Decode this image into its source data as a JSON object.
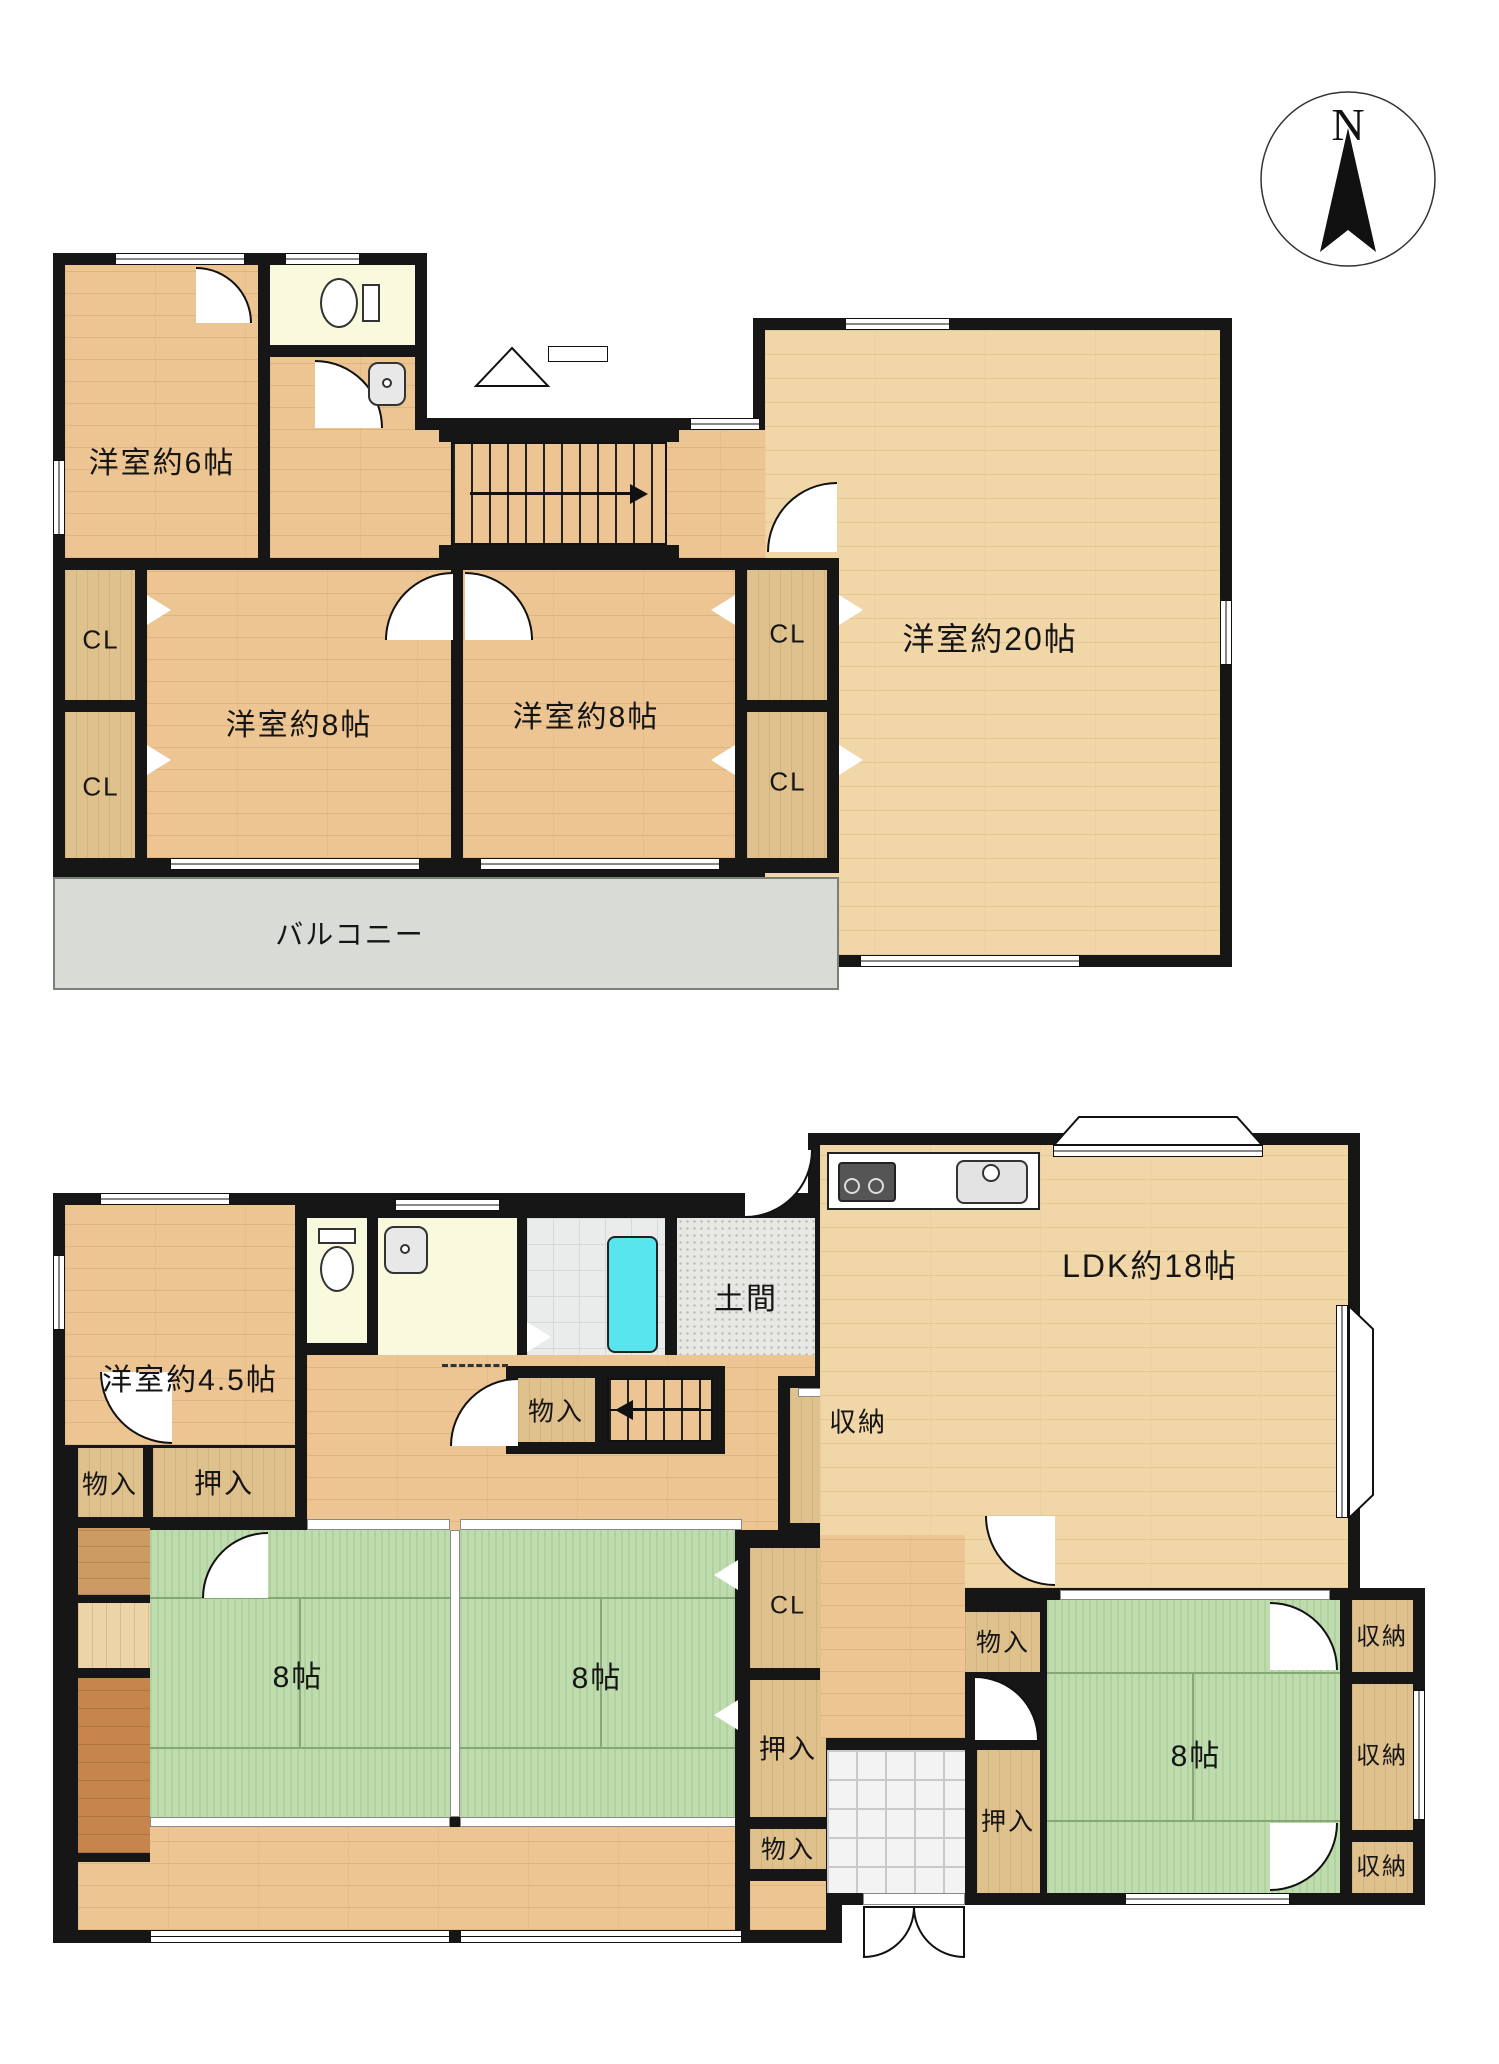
{
  "compass": {
    "label": "N"
  },
  "floor2": {
    "room_6": "洋室約6帖",
    "room_8_left": "洋室約8帖",
    "room_8_right": "洋室約8帖",
    "room_20": "洋室約20帖",
    "balcony": "バルコニー",
    "cl_left_top": "CL",
    "cl_left_bottom": "CL",
    "cl_right_top": "CL",
    "cl_right_bottom": "CL"
  },
  "floor1": {
    "room_45": "洋室約4.5帖",
    "ldk": "LDK約18帖",
    "doma": "土間",
    "tatami_left": "8帖",
    "tatami_center": "8帖",
    "tatami_right": "8帖",
    "monoire_left": "物入",
    "oshiire_left": "押入",
    "monoire_stairs": "物入",
    "shuno_hall": "収納",
    "cl_mid": "CL",
    "oshiire_mid": "押入",
    "monoire_mid": "物入",
    "monoire_genkan": "物入",
    "oshiire_genkan": "押入",
    "shuno_right_top": "収納",
    "shuno_right_mid": "収納",
    "shuno_right_bottom": "収納"
  },
  "icons": {
    "compass": "compass-rose",
    "toilet": "toilet-icon",
    "sink": "sink-icon",
    "bathtub": "bathtub-icon",
    "stove": "stove-icon",
    "kitchen_sink": "kitchen-sink-icon",
    "stairs": "stairs-arrow",
    "door": "door-swing-arc"
  },
  "colors": {
    "wall": "#161616",
    "wood": "#ecc592",
    "wood_light": "#f1d7a8",
    "closet": "#dfc18d",
    "tatami": "#bedcad",
    "balcony": "#d9dcd6",
    "sanitary": "#f9f9de",
    "bath_tile": "#eaecec",
    "tub": "#59e5ee",
    "doma": "#e7e7e3",
    "tile": "#f3f3f3",
    "strip_mid": "#cb9b63",
    "strip_light": "#ecd3a8",
    "strip_dark": "#c6854d"
  }
}
